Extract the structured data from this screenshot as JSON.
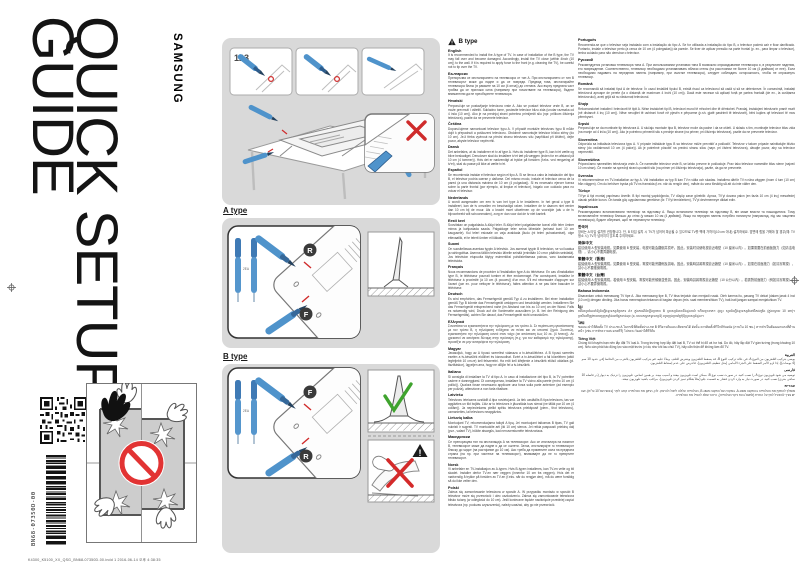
{
  "page": {
    "title_line1": "QUICK SETUP",
    "title_line2": "GUIDE",
    "brand": "SAMSUNG",
    "part_number": "BN68-07350D-00",
    "print_footer": "K4300_K5100_XX_QSG_BN68-07350D-00.indd   1      2016-06-14   오후 4:38:35"
  },
  "diagrams": {
    "step_label": "123",
    "a_type_label": "A type",
    "b_type_label": "B type",
    "screw_rear_label": "R",
    "screw_front_label": "F",
    "qty_label": "2EA"
  },
  "instructions": {
    "header": "B type",
    "left": [
      {
        "lang": "English",
        "text": "It is recommended to install the A type of TV. In case of installation of the B type, the TV may fall over and become damaged. Accordingly, install the TV close (within 4inch (10 cm)) to the wall. If it is required to apply force to the front (e.g. cleaning the TV), be careful not to tip over the TV."
      },
      {
        "lang": "Български",
        "text": "Препоръчва се инсталирането на телевизора от тип A. При инсталирането от тип B телевизорът може да падне и да се повреди. Предвид това, инсталирайте телевизора близо (в рамките на 10 см (4 инча)) до стената. Ако върху предната част трябва да се приложи сила (например при почистване на телевизора), бъдете внимателни да не преобърнете телевизора."
      },
      {
        "lang": "Hrvatski",
        "text": "Preporučuje se postavljanje televizora vrste A. Ako se postavi televizor vrste B, on se može prevrnuti i oštetiti. Sukladno tome, postavite televizor blizu zida (unutar razmaka od 4 inča (10 cm)). Ako je na prednjoj strani potrebno primijeniti silu (npr. prilikom čišćenja televizora), pazite da ne prevrnete televizor."
      },
      {
        "lang": "Čeština",
        "text": "Doporučujeme namontovat televizor typu A. V případě montáže televizoru typu B může dojít k přepadnutí a poškození televizoru. Obdobně namontujte televizor blízko stěny (do 10 cm). Je-li třeba vyvinout na přední stranu televizoru sílu (například při čištění), dejte pozor, abyste televizor nepřevrhli."
      },
      {
        "lang": "Dansk",
        "text": "Det anbefales, at du installerer et tv af type A. Hvis du installerer type B, kan tv'et vælte og blive beskadiget. Derudover skal du installere tv'et tæt på væggen (inden for en afstand på 10 cm (4 tommer)). Hvis det er nødvendigt at trykke på forsiden (f.eks. ved rengøring af tv'et), skal du passe på ikke at vælte tv'et."
      },
      {
        "lang": "Español",
        "text": "Se recomienda instalar el televisor según el tipo A. Si se lleva a cabo la instalación del tipo B, el televisor podría caerse y dañarse. Del mismo modo, instale el televisor cerca de la pared (a una distancia máxima de 10 cm (4 pulgadas)). Si es necesario ejercer fuerza sobre la parte frontal (por ejemplo, al limpiar el televisor), hágalo con cuidado para no volcar el televisor."
      },
      {
        "lang": "Nederlands",
        "text": "U wordt aangeraden om een tv van het type A te installeren. In het geval u type B installeert, kan de tv omvallen en beschadigd raken. Installeer de tv daarom niet verder dan 10 cm bij de muur. Als u kracht moet uitoefenen op de voorzijde (als u de tv bijvoorbeeld wilt schoonmaken), zorg er dan voor dat de tv niet kantelt."
      },
      {
        "lang": "Eesti keel",
        "text": "Soovitatav on paigaldada A-tüüpi teler. B-tüüpi teleri paigaldamise korral võib teler ümber minna ja kahjustada saada. Paigaldage teler seina lähedale (seinast kuni 10 cm kaugusele). Kui teleri esiosale on vaja avaldada jõudu (nt teleri puhastamisel), olge ettevaatlik, et te telerit ümber ei lükkaks."
      },
      {
        "lang": "Suomi",
        "text": "On suositeltavaa asentaa tyypin A televisio. Jos asennat tyypin B television, se voi kaatua ja vahingoittua. Asenna tällöin televisio lähelle seinää (enintään 10 cm:n päähän seinästä). Jos television etupuolta täytyy esimerkiksi puhdistettaessa painaa, varo kaatamasta televisiota."
      },
      {
        "lang": "Français",
        "text": "Nous recommandons de procéder à l'installation type A du téléviseur. En cas d'installation type B, le téléviseur pourrait tomber et être endommagé. Par conséquent, installez le téléviseur à proximité (à 10 cm (4 pouces)) d'un mur. S'il est nécessaire d'appuyer sur l'avant (par ex. pour nettoyer le téléviseur), faites attention à ne pas faire basculer le téléviseur."
      },
      {
        "lang": "Deutsch",
        "text": "Es wird empfohlen, das Fernsehgerät gemäß Typ A zu installieren. Bei einer Installation gemäß Typ B könnte das Fernsehgerät umkippen und beschädigt werden. Installieren Sie das Fernsehgerät entsprechend nahe (im Abstand von bis zu 10 cm) an der Wand. Falls es notwendig wird, Druck auf die Vorderseite auszuüben (z. B. bei der Reinigung des Fernsehgeräts), achten Sie darauf, das Fernsehgerät nicht umzustoßen."
      },
      {
        "lang": "Ελληνικά",
        "text": "Συνιστάται να εγκαταστήσετε την τηλεόραση με τον τρόπο A. Σε περίπτωση εγκατάστασης με τον τρόπο B, η τηλεόραση ενδέχεται να πέσει και να υποστεί ζημιά. Συνεπώς, εγκαταστήστε την τηλεόραση κοντά στον τοίχο (σε απόσταση έως 10 εκ. (4 ίντσες)). Αν χρειαστεί να ασκήσετε δύναμη στην πρόσοψη (π.χ. για τον καθαρισμό της τηλεόρασης), προσέξτε να μην ανατρέψετε την τηλεόραση."
      },
      {
        "lang": "Magyar",
        "text": "Javasoljuk, hogy az A típusú szerelést válassza a tv-készülékhez. A B típusú szerelés esetén a tv-készülék eldőlhet és károsodhat. Ezért a tv-készüléket a fal közelében (attól legfeljebb 10 cm-re) kell felszerelni. Ha erőt kell kifejtenie a készülék elülső oldalára (pl. tisztításkor), ügyeljen arra, hogy ne dőljön fel a tv-készülék."
      },
      {
        "lang": "Italiano",
        "text": "Si consiglia di installare la TV di tipo A. In caso di installazione del tipo B, la TV potrebbe cadere e danneggiarsi. Di conseguenza, installare la TV vicino alla parete (entro 10 cm (4 pollici)). Qualora fosse necessario applicare una forza sulla parte anteriore (ad esempio per pulizia), attenzione a non farla ribaltare."
      },
      {
        "lang": "Latviešu",
        "text": "Televizoru ieteicams uzstādīt A tipa novietojumā. Ja tiek uzstādīts B tipa televizors, tas var apgāzties un tikt bojāts. Līdz ar to televizors ir jāuzstāda tuvu sienai (ne tālāk par 10 cm (4 collām)). Ja nepieciešams pielikt spēku televizora priekšpusē (piem., tīrot televizoru), uzmanieties, lai televizors neapgāztos."
      },
      {
        "lang": "Lietuvių kalba",
        "text": "Montuojant TV, rekomenduojama taikyti A tipą. Jei montuojant taikomas B tipas, TV gali nukristi ir sugesti. TV montuokite arti (iki 10 cm) sienos. Jei reikia paspausti priekinę dalį (pvz., valant TV), būkite atsargūs, kad nenuverstumėte televizoriaus."
      },
      {
        "lang": "Македонски",
        "text": "Се препорачува тип на инсталација A на телевизорот. Ако се инсталира на начинот B, телевизорот може да падне и да се оштети. Затоа, инсталирајте го телевизорот блиску до ѕидот (на растојание до 10 см). Ако треба да примените сила на предната страна (на пр. при чистење на телевизорот), внимавајте да не го превртите телевизорот."
      },
      {
        "lang": "Norsk",
        "text": "Vi anbefaler en TV-installasjon av A-typen. Hvis B-typen installeres, kan TV-en velte og bli skadet. Installer derfor TV-en nær veggen (innenfor 10 cm fra veggen). Hvis det er nødvendig å trykke på forsiden av TV-en (f.eks. når du rengjør den), må du være forsiktig så du ikke velter den."
      },
      {
        "lang": "Polski",
        "text": "Zaleca się zamontowanie telewizora w sposób A. W przypadku montażu w sposób B telewizor może się przewrócić i ulec uszkodzeniu. Zaleca się zamontowanie telewizora blisko ściany (w odległości do 10 cm). Jeśli konieczne będzie naciśnięcie przedniej części telewizora (np. podczas czyszczenia), należy uważać, aby go nie przewrócić."
      }
    ],
    "right": [
      {
        "lang": "Português",
        "text": "Recomenda-se que o televisor seja instalado com a instalação do tipo A. Se for utilizada a instalação do tipo B, o televisor poderá cair e ficar danificado. Portanto, instale o televisor perto (a cerca de 10 cm (4 polegadas)) da parede. Se tiver de aplicar pressão na parte frontal (p. ex., para limpar o televisor), tenha cuidado para não derrubar o televisor."
      },
      {
        "lang": "Русский",
        "text": "Рекомендуется установка телевизора типа A. При использовании установки типа B возможно опрокидывание телевизора и, в результате падения, его повреждение. Соответственно, телевизор необходимо устанавливать вблизи стены (на расстоянии не более 10 см (4 дюймов) от нее). Если необходимо надавить на переднюю панель (например, при очистке телевизора), следует соблюдать осторожность, чтобы не опрокинуть телевизор."
      },
      {
        "lang": "Română",
        "text": "Se recomandă să instalați tipul A de televizor. În cazul instalării tipului B, există riscul ca televizorul să cadă și să se deterioreze. În consecință, instalați televizorul aproape de perete (la o distanță de maximum 4 inchi (10 cm)). Dacă este necesar să aplicați forță pe partea frontală (de ex., la curățarea televizorului), aveți grijă să nu răsturnați televizorul."
      },
      {
        "lang": "Shqip",
        "text": "Rekomandohet instalimi i televizorit të tipit A. Nëse instalohet tipi B, televizori mund të rrëzohet dhe të dëmtohet. Prandaj, instalojeni televizorin pranë murit (në distancë 4 inç (10 cm)). Nëse nevojitet të ushtroni forcë në pjesën e përparme (p.sh. gjatë pastrimit të televizorit), bëni kujdes që televizori të mos përmbyset."
      },
      {
        "lang": "Srpski",
        "text": "Preporučuje se da montirate tip televizora A. U slučaju montaže tipa B, televizor može da padne i da se ošteti. U skladu s tim, montirajte televizor blizu zida (na manje od 4 inča (10 cm)). Ako je potrebno primeniti silu s prednje strane (na primer, pri čišćenju televizora), pazite da ne prevrnete televizor."
      },
      {
        "lang": "Slovenčina",
        "text": "Odporúča sa inštalácia televízora typu A. V prípade inštalácie typu B sa televízor môže prevrátiť a poškodiť. Televízor v takom prípade nainštalujte blízko steny (do vzdialenosti 10 cm (4 palce)). Ak je potrebné pôsobiť na prednú stranu silou (napr. pri čistení televízora), dávajte pozor, aby sa televízor neprevrátil."
      },
      {
        "lang": "Slovenščina",
        "text": "Priporočamo namestitev televizorja vrste A. Če namestite televizor vrste B, se lahko prevrne in poškoduje. Prav tako televizor namestite blizu stene (največ 10 cm stran). Če morate na sprednji strani uporabiti silo (na primer pri čiščenju televizorja), pazite, da ga ne prevrnete."
      },
      {
        "lang": "Svenska",
        "text": "Vi rekommenderar en TV-installation av typ A. Vid installation av typ B kan TV:n välta och skadas. Installera därför TV:n nära väggen (inom 4 tum (10 cm) från väggen). Om du behöver trycka på TV:ns framsida (t.ex. när du rengör den), måste du vara försiktig så att du inte välter den."
      },
      {
        "lang": "Türkçe",
        "text": "TV'ye A tipi montaj yapılması önerilir. B tipi montaj yapıldığında, TV düşüp zarar görebilir. Ayrıca, TV'yi duvara yakın (en fazla 10 cm (4 inç) mesafede) olacak şekilde kurun. Ön tarafa güç uygulanması gerekirse (ör. TV'yi temizlerken), TV'yi devirmemeye dikkat edin."
      },
      {
        "lang": "Українська",
        "text": "Рекомендовано встановлювати телевізор на підставку A. Якщо встановити телевізор на підставку B, він може впасти та пошкодитися. Тому встановлюйте телевізор близько до стіни (у межах 10 см (4 дюймів)). Якщо на передню панель потрібно натиснути (наприклад, під час чищення телевізора), будьте обережні, щоб не перекинути телевізор."
      },
      {
        "lang": "한국어",
        "text": "장비는 A 타입 설치를 권장합니다. 단, B 타입 설치 시 TV가 넘어져 파손될 수 있으므로 TV를 벽에 가까이(10 cm 이내) 설치하세요. 앞면에 힘을 가해야 할 경우(예: TV 청소 시) TV가 넘어지지 않도록 주의하세요."
      },
      {
        "lang": "简体中文",
        "text": "建议使用 A 型安装电视。如果使用 B 型安装，电视可能会翻倒并损坏。因此，安装时请使电视靠近墙壁（10 厘米以内）。如果需要在前面板施力（如清洁电视），请小心不要弄翻电视。"
      },
      {
        "lang": "繁體中文（香港）",
        "text": "建議使用 A 型安裝電視。如果使用 B 型安裝，電視可能會翻側及損壞。因此，安裝時請將電視靠近牆壁（10 厘米以內）。如需在前面施力（如清潔電視），請小心不要推倒電視。"
      },
      {
        "lang": "繁體中文（台灣）",
        "text": "建議使用 A 型安裝電視。若使用 B 型安裝，電視可能會傾倒並受損。因此，安裝時請將電視靠近牆壁（10 公分以內）。若需對前面施力（例如清潔電視），請小心不要弄倒電視。"
      },
      {
        "lang": "Bahasa Indonesia",
        "text": "Disarankan untuk memasang TV tipe A. Jika memasang tipe B, TV bisa terjatuh dan menjadi rusak. Oleh karena itu, pasang TV dekat (dalam jarak 4 inci (10 cm)) dengan dinding. Jika harus menerapkan tekanan di bagian depan (mis. saat membersihkan TV), hati-hati jangan sampai menjatuhkan TV."
      },
      {
        "lang": "ខ្មែរ",
        "text": "យើងសូមណែនាំឱ្យដំឡើងទូរទស្សន៍ប្រភេទ A។ ក្នុងករណីដំឡើងប្រភេទ B ទូរទស្សន៍អាចនឹងដួលរលំ ហើយខូចខាត។ ដូច្នេះ សូមដំឡើងទូរទស្សន៍នៅជិតជញ្ជាំង (ក្នុងចម្ងាយ 10 cm)។ ប្រសិនបើត្រូវការបញ្ចេញកម្លាំងនៅផ្នែកខាងមុខ (ឧ. ពេលសម្អាតទូរទស្សន៍) សូមប្រុងប្រយ័ត្នកុំឱ្យទូរទស្សន៍ដួល។"
      },
      {
        "lang": "ไทย",
        "text": "ขอแนะนำให้ติดตั้ง TV ประเภท A ในกรณีที่ติดตั้งประเภท B ทีวีอาจล้มและเสียหายได้ ดังนั้น ควรติดตั้งทีวีใกล้กับผนัง (ภายใน 10 ซม.) หากจำเป็นต้องออกแรงที่ด้านหน้า (เช่น การทำความสะอาดทีวี) โปรดระวังอย่าให้ทีวีล้ม"
      },
      {
        "lang": "Tiếng Việt",
        "text": "Chúng tôi khuyên bạn nên lắp đặt TV loại A. Trong trường hợp lắp đặt loại B, TV có thể bị đổ và hư hại. Do đó, hãy lắp đặt TV gần tường (trong khoảng 10 cm). Nếu cần phải tác động lực vào mặt trước (ví dụ như khi lau chùi TV), hãy cẩn thận để không làm đổ TV."
      },
      {
        "lang": "العربية",
        "rtl": true,
        "text": "يوصى بتركيب التلفزيون من النوع A. في حالة تركيب النوع B، قد يسقط التلفزيون ويتعرض للتلف. وبناءً عليه، قم بتركيب التلفزيون بالقرب من الحائط (في حدود 10 سم (4 بوصات)). إذا لزم الأمر الضغط على الجزء الأمامي (مثل تنظيف التلفزيون)، فاحرص على عدم إسقاط التلفزيون."
      },
      {
        "lang": "فارسی",
        "rtl": true,
        "text": "توصیه می شود تلویزیون نوع A را نصب کنید. در صورت نصب نوع B، ممکن است تلویزیون بیفتد و آسیب ببیند. بر همین اساس، تلویزیون را نزدیک به دیوار (در فاصله 10 سانتی متری) نصب کنید. در صورت نیاز به وارد کردن فشار به قسمت جلو (مثلاً هنگام تمیز کردن تلویزیون)، مراقب باشید تلویزیون نیفتد."
      },
      {
        "lang": "עברית",
        "rtl": true,
        "text": "מומלץ להתקין את הטלוויזיה בהתקנה מסוג A. במקרה של התקנה מסוג B, הטלוויזיה עלולה ליפול ולהינזק. לכן, התקן את הטלוויזיה קרוב לקיר (בטווח של 10 ס״מ). אם יש צורך להפעיל לחץ על החזית (למשל בעת ניקוי הטלוויזיה), היזהר שלא להפיל את הטלוויזיה."
      }
    ]
  },
  "colors": {
    "panel_gray": "#d9d9d9",
    "tool_blue": "#4f93cb",
    "tool_blue_dark": "#2d5c8c",
    "error_red": "#d02c2c",
    "ok_green": "#3fa32e",
    "prohibition_red": "#e23333"
  }
}
